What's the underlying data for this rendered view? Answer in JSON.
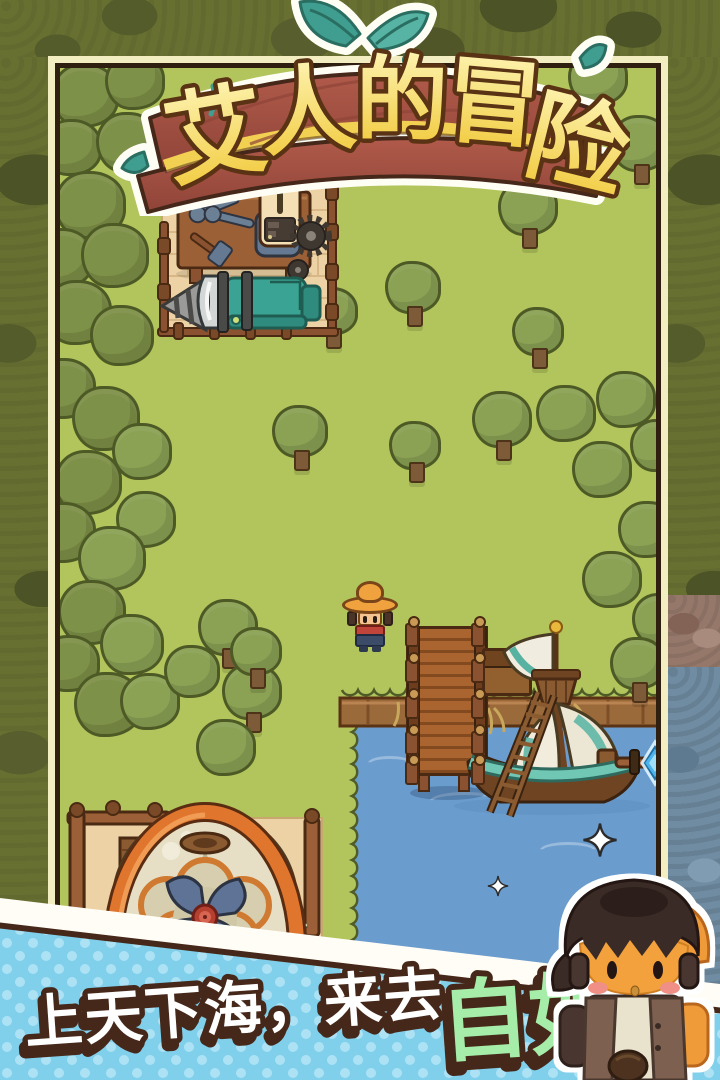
{
  "title": {
    "text": "艾人的冒险",
    "chars": [
      "艾",
      "人",
      "的",
      "冒",
      "险"
    ]
  },
  "tagline": {
    "white": "上天下海，来去",
    "highlight": "自如"
  },
  "colors": {
    "grass": "#b2c45c",
    "water": "#6b9cce",
    "frame_cream": "#f2eec2",
    "frame_dark": "#2f1f10",
    "banner_blue": "#80cfeb",
    "banner_dot": "#ade2f5",
    "outline_dark": "#45281a",
    "title_yellow": "#f1c93a",
    "highlight_green": "#a5eda8",
    "sign_wood": "#a85648",
    "leaf_teal": "#3f9e8f",
    "machine_teal": "#3aa393",
    "balloon_orange": "#e0762e"
  },
  "scene": {
    "trees": [
      {
        "x": 85,
        "y": 95,
        "s": 34,
        "tone": "dark"
      },
      {
        "x": 135,
        "y": 82,
        "s": 30,
        "tone": "dark"
      },
      {
        "x": 72,
        "y": 148,
        "s": 30,
        "tone": "dark"
      },
      {
        "x": 128,
        "y": 142,
        "s": 32,
        "tone": "dark"
      },
      {
        "x": 90,
        "y": 205,
        "s": 36,
        "tone": "dark"
      },
      {
        "x": 62,
        "y": 258,
        "s": 32,
        "tone": "dark"
      },
      {
        "x": 115,
        "y": 255,
        "s": 34,
        "tone": "dark"
      },
      {
        "x": 78,
        "y": 312,
        "s": 34,
        "tone": "dark"
      },
      {
        "x": 122,
        "y": 335,
        "s": 32,
        "tone": "dark"
      },
      {
        "x": 64,
        "y": 388,
        "s": 32,
        "tone": "dark"
      },
      {
        "x": 106,
        "y": 418,
        "s": 34,
        "tone": "dark"
      },
      {
        "x": 142,
        "y": 452,
        "s": 30,
        "tone": "mid"
      },
      {
        "x": 88,
        "y": 482,
        "s": 34,
        "tone": "dark"
      },
      {
        "x": 64,
        "y": 532,
        "s": 32,
        "tone": "dark"
      },
      {
        "x": 146,
        "y": 520,
        "s": 30,
        "tone": "mid"
      },
      {
        "x": 112,
        "y": 558,
        "s": 34,
        "tone": "mid"
      },
      {
        "x": 92,
        "y": 612,
        "s": 34,
        "tone": "dark"
      },
      {
        "x": 132,
        "y": 644,
        "s": 32,
        "tone": "mid"
      },
      {
        "x": 70,
        "y": 664,
        "s": 30,
        "tone": "dark"
      },
      {
        "x": 108,
        "y": 704,
        "s": 34,
        "tone": "dark"
      },
      {
        "x": 150,
        "y": 702,
        "s": 30,
        "tone": "mid"
      },
      {
        "x": 192,
        "y": 672,
        "s": 28,
        "tone": "mid"
      },
      {
        "x": 228,
        "y": 628,
        "s": 30,
        "tone": "mid",
        "trunk": true
      },
      {
        "x": 252,
        "y": 692,
        "s": 30,
        "tone": "mid",
        "trunk": true
      },
      {
        "x": 226,
        "y": 748,
        "s": 30,
        "tone": "mid"
      },
      {
        "x": 332,
        "y": 312,
        "s": 26,
        "tone": "mid",
        "trunk": true
      },
      {
        "x": 300,
        "y": 432,
        "s": 28,
        "tone": "mid",
        "trunk": true
      },
      {
        "x": 413,
        "y": 288,
        "s": 28,
        "tone": "mid",
        "trunk": true
      },
      {
        "x": 538,
        "y": 332,
        "s": 26,
        "tone": "mid",
        "trunk": true
      },
      {
        "x": 256,
        "y": 652,
        "s": 26,
        "tone": "mid",
        "trunk": true
      },
      {
        "x": 415,
        "y": 446,
        "s": 26,
        "tone": "mid",
        "trunk": true
      },
      {
        "x": 470,
        "y": 96,
        "s": 28,
        "tone": "mid"
      },
      {
        "x": 598,
        "y": 78,
        "s": 30,
        "tone": "mid"
      },
      {
        "x": 640,
        "y": 144,
        "s": 30,
        "tone": "mid",
        "trunk": true
      },
      {
        "x": 528,
        "y": 208,
        "s": 30,
        "tone": "mid",
        "trunk": true
      },
      {
        "x": 502,
        "y": 420,
        "s": 30,
        "tone": "mid",
        "trunk": true
      },
      {
        "x": 566,
        "y": 414,
        "s": 30,
        "tone": "mid"
      },
      {
        "x": 626,
        "y": 400,
        "s": 30,
        "tone": "mid"
      },
      {
        "x": 658,
        "y": 446,
        "s": 28,
        "tone": "mid"
      },
      {
        "x": 602,
        "y": 470,
        "s": 30,
        "tone": "mid"
      },
      {
        "x": 648,
        "y": 530,
        "s": 30,
        "tone": "mid"
      },
      {
        "x": 612,
        "y": 580,
        "s": 30,
        "tone": "mid"
      },
      {
        "x": 660,
        "y": 620,
        "s": 28,
        "tone": "mid"
      },
      {
        "x": 638,
        "y": 664,
        "s": 28,
        "tone": "mid",
        "trunk": true
      }
    ],
    "sparkles": [
      {
        "x": 600,
        "y": 840,
        "s": 36
      },
      {
        "x": 498,
        "y": 886,
        "s": 22
      },
      {
        "x": 574,
        "y": 910,
        "s": 14
      },
      {
        "x": 630,
        "y": 902,
        "s": 16
      }
    ],
    "dock": {
      "post_rows": [
        -6,
        30,
        66,
        102,
        132
      ]
    }
  }
}
